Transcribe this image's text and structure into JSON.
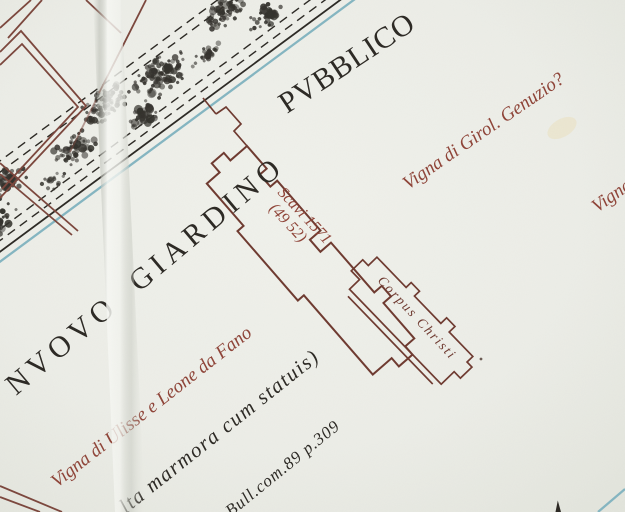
{
  "map": {
    "labels": {
      "park_line1": "NVOVO GIARDINO",
      "park_line2": "PVBBLICO",
      "vigna_genuzio": "Vigna di Girol. Genuzio?",
      "vigna_right_partial": "Vigna",
      "vigna_ulisse": "Vigna di Ulisse e Leone da Fano",
      "scavi_line1": "Scavi 1571",
      "scavi_line2": "(49 52)",
      "corpus_christi": "Corpus Christi",
      "note_marmora": "lta marmora cum statuis)",
      "note_reference": "Bull.com.89 p.309"
    },
    "colors": {
      "paper": "#ecede7",
      "paper_light": "#f1f2ec",
      "paper_dark": "#e3e5dd",
      "ink_black": "#2b2823",
      "ink_maroon": "#6e392f",
      "ink_diamond": "#7b463c",
      "ink_red": "#8e4337",
      "ink_blue": "#84b5c1",
      "stipple": "#33312c"
    }
  }
}
